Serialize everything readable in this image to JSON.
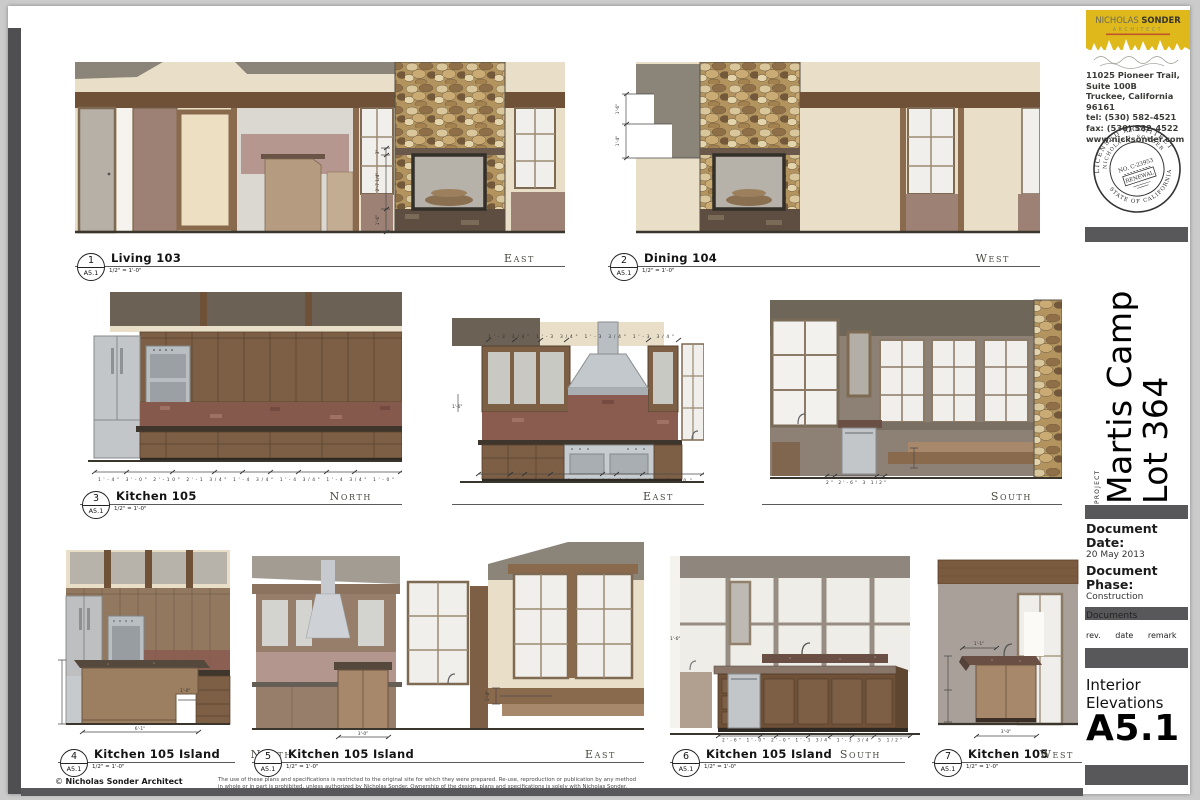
{
  "palette": {
    "canvas_bg": "#cbcbcb",
    "sheet_bg": "#ffffff",
    "accent_bar_gray": "#58585a",
    "logo_yellow": "#dfb81c",
    "wall_cream": "#e9dfc8",
    "roof_gray": "#8b8478",
    "soffit_gray": "#6b6154",
    "wood_beam": "#6f5138",
    "cabinet_wood": "#7d5f45",
    "backsplash_red": "#8a5c50",
    "stainless": "#c2c6c9",
    "glass_white": "#f0efeb",
    "stone_tan": "#b3945f",
    "taupe_wall": "#8d8176"
  },
  "title_block": {
    "logo": {
      "name_thin": "NICHOLAS",
      "name_bold": "SONDER",
      "subtitle": "ARCHITECT"
    },
    "address_lines": [
      "11025 Pioneer Trail, Suite 100B",
      "Truckee, California  96161",
      "tel: (530) 582-4521",
      "fax:     (530) 582-4522",
      "www.nicksonder.com"
    ],
    "stamp": {
      "arc_top": "LICENSED ARCHITECT",
      "arc_name": "NICHOLAS J. SONDER",
      "license": "NO. C-23953",
      "renewal": "RENEWAL",
      "arc_bottom": "STATE OF CALIFORNIA"
    },
    "project_label": "PROJECT",
    "project_name_line1": "Martis Camp",
    "project_name_line2": "Lot 364",
    "doc_date_label": "Document Date:",
    "doc_date": "20 May 2013",
    "doc_phase_label": "Document Phase:",
    "doc_phase_line1": "Construction",
    "doc_phase_line2": "Documents",
    "rev_headers": [
      "rev.",
      "date",
      "remark"
    ],
    "sheet_title_line1": "Interior",
    "sheet_title_line2": "Elevations",
    "sheet_number": "A5.1"
  },
  "drawings": {
    "d1": {
      "num": "1",
      "sheet": "A5.1",
      "title": "Living 103",
      "direction": "East",
      "scale": "1/2\" = 1'-0\"",
      "dims": {
        "a": "3\"",
        "b": "2'-7 1/4\"",
        "c": "1'-6\""
      }
    },
    "d2": {
      "num": "2",
      "sheet": "A5.1",
      "title": "Dining 104",
      "direction": "West",
      "scale": "1/2\" = 1'-0\"",
      "dims": {
        "a": "1'-6\"",
        "b": "1'-4\""
      }
    },
    "d3": {
      "num": "3",
      "sheet": "A5.1",
      "title": "Kitchen 105",
      "scale": "1/2\" = 1'-0\"",
      "directions": {
        "north": "North",
        "east": "East",
        "south": "South"
      },
      "dims": {
        "north_bottom": "1'-4\"  3'-0\"  2'-10\"  2'-1 3/4\"  1'-4 3/4\"  1'-4 3/4\"  1'-4 3/4\"  1'-0\"",
        "east_top": "1'-3 3/4\"  1'-3 3/4\"  1'-3 3/4\"  1'-3 3/4\"",
        "east_side": "1'-6\"",
        "east_bottom": "2'-6\"  1'-0\"  2'-0\"  4'-0\"  11 1/2\"  2'-0\"",
        "south_bottom": "2\"  2'-6\"  3 1/2\""
      }
    },
    "d4": {
      "num": "4",
      "sheet": "A5.1",
      "title": "Kitchen 105 Island",
      "direction": "North",
      "scale": "1/2\" = 1'-0\"",
      "dims": {
        "bottom": "6'-1\"",
        "notch": "1'-0\""
      }
    },
    "d5": {
      "num": "5",
      "sheet": "A5.1",
      "title": "Kitchen 105 Island",
      "direction": "East",
      "scale": "1/2\" = 1'-0\"",
      "dims": {
        "island": "3'-0\"",
        "bench": "1'-4\""
      }
    },
    "d6": {
      "num": "6",
      "sheet": "A5.1",
      "title": "Kitchen 105 Island",
      "direction": "South",
      "scale": "1/2\" = 1'-0\"",
      "dims": {
        "bottom": "2'-6\"  1'-0\"  2'-0\"  1'-3 3/4\"  1'-3 3/4\"  5 1/2\"",
        "side": "1'-6\""
      }
    },
    "d7": {
      "num": "7",
      "sheet": "A5.1",
      "title": "Kitchen 105",
      "direction": "West",
      "scale": "1/2\" = 1'-0\"",
      "dims": {
        "top": "1'-1\"",
        "bottom": "3'-0\""
      }
    }
  },
  "footer": {
    "copyright_symbol": "©",
    "copyright_name": "Nicholas Sonder Architect",
    "legal_line1": "The use of these plans and specifications is restricted to the original site for which they were prepared.  Re-use, reproduction or publication by any method",
    "legal_line2": "in whole or in part is prohibited, unless authorized by Nicholas Sonder.  Ownership of the design, plans and specifications is solely with Nicholas Sonder."
  }
}
